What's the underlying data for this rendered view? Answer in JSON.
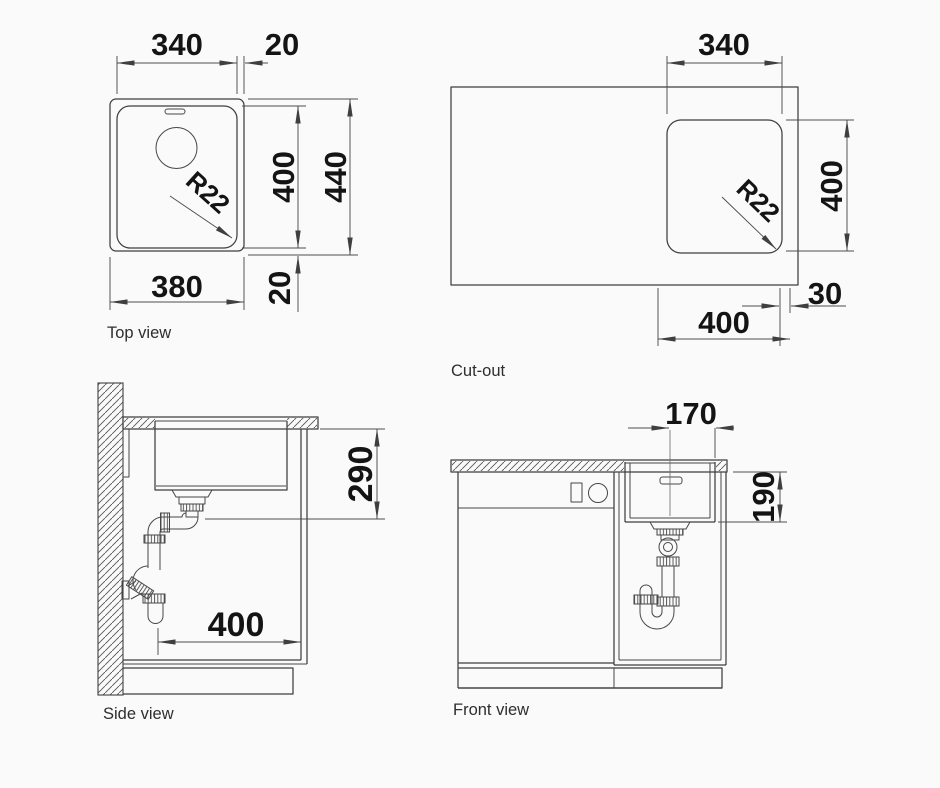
{
  "colors": {
    "line": "#3f3f3f",
    "dim_line": "#4d4d4d",
    "dim_text": "#141414",
    "label_text": "#2e2e2e",
    "background": "#fafafa"
  },
  "views": {
    "top_view": {
      "label": "Top view",
      "dims": {
        "bowl_width": "340",
        "rim_offset_right": "20",
        "bowl_depth": "400",
        "overall_depth": "440",
        "overall_width": "380",
        "rim_offset_front": "20",
        "corner_radius": "R22"
      }
    },
    "cutout_view": {
      "label": "Cut-out",
      "dims": {
        "width": "340",
        "depth": "400",
        "corner_radius": "R22",
        "offset_to_cabinet_side": "30",
        "cabinet_width": "400"
      }
    },
    "side_view": {
      "label": "Side view",
      "dims": {
        "outlet_height": "290",
        "cabinet_depth": "400"
      }
    },
    "front_view": {
      "label": "Front view",
      "dims": {
        "drain_center_to_edge": "170",
        "bowl_depth": "190"
      }
    }
  }
}
